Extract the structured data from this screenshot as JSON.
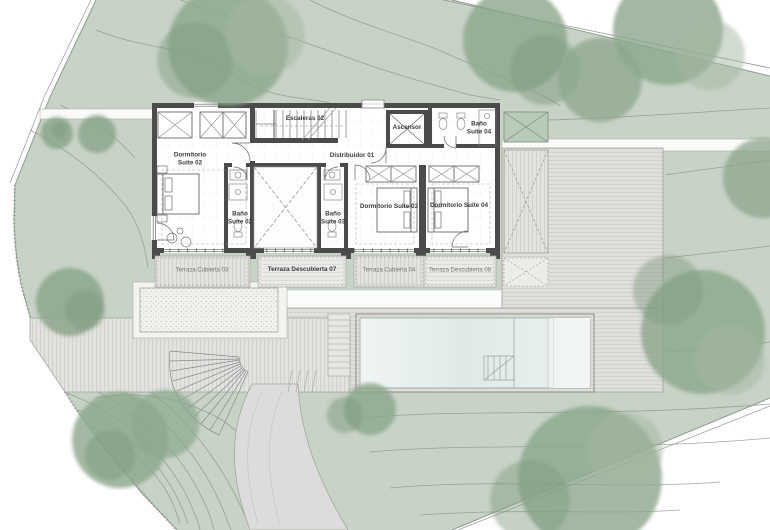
{
  "plan": {
    "rooms": {
      "escaleras_02": "Escaleras 02",
      "distribuidor_01": "Distribuidor 01",
      "ascensor": "Ascensor",
      "dormitorio_suite_02": "Dormitorio\nSuite 02",
      "bano_suite_02": "Baño\nSuite 02",
      "bano_suite_03": "Baño\nSuite 03",
      "bano_suite_04": "Baño\nSuite 04",
      "dormitorio_suite_03": "Dormitorio Suite 03",
      "dormitorio_suite_04": "Dormitorio Suite 04"
    },
    "terraces": {
      "terraza_cubierta_03": "Terraza Cubierta 03",
      "terraza_descubierta_07": "Terraza Descubierta 07",
      "terraza_cubierta_04": "Terraza Cubierta 04",
      "terraza_descubierta_08": "Terraza Descubierta 08"
    },
    "colors": {
      "terrain": "#c7d3c6",
      "tree": "#8ca68b",
      "walls": "#4b4b4b",
      "paving": "#dfdfdc",
      "water": "#e3edeb",
      "boundary": "#8f9b8f"
    }
  }
}
